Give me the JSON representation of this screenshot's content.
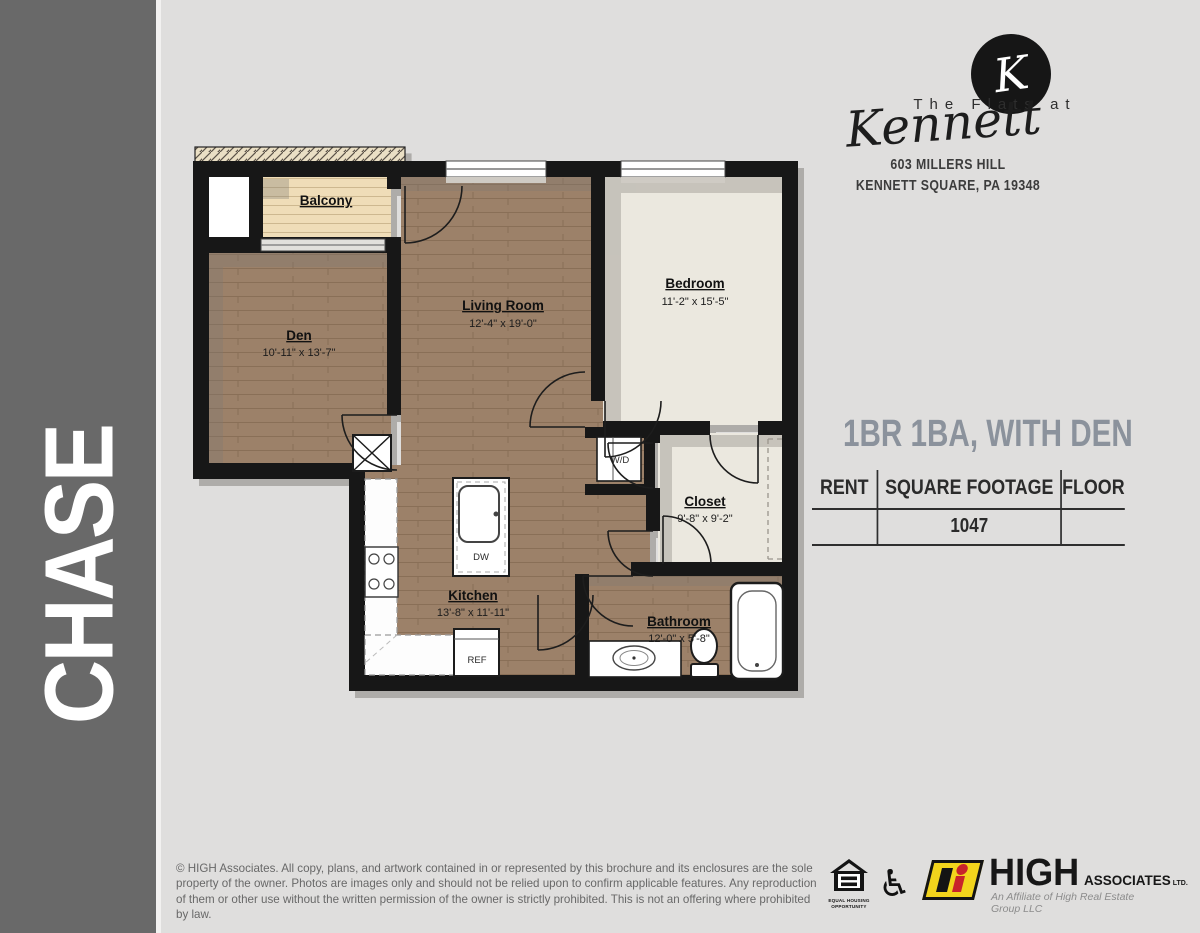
{
  "sidebar": {
    "plan_name": "CHASE"
  },
  "brand": {
    "monogram": "K",
    "name_top": "The Flats at",
    "name_script": "Kennett",
    "address_line1": "603 MILLERS HILL",
    "address_line2": "KENNETT SQUARE, PA 19348"
  },
  "unit": {
    "headline": "1BR 1BA, WITH DEN",
    "specs": {
      "columns": [
        "RENT",
        "SQUARE FOOTAGE",
        "FLOOR"
      ],
      "rent": "",
      "square_footage": "1047",
      "floor": ""
    }
  },
  "floorplan": {
    "rooms": {
      "balcony": {
        "name": "Balcony"
      },
      "den": {
        "name": "Den",
        "dims": "10'-11\" x 13'-7\""
      },
      "living": {
        "name": "Living Room",
        "dims": "12'-4\" x 19'-0\""
      },
      "bedroom": {
        "name": "Bedroom",
        "dims": "11'-2\" x 15'-5\""
      },
      "closet": {
        "name": "Closet",
        "dims": "9'-8\" x 9'-2\""
      },
      "kitchen": {
        "name": "Kitchen",
        "dims": "13'-8\" x 11'-11\""
      },
      "bathroom": {
        "name": "Bathroom",
        "dims": "12'-0\" x 5'-8\""
      }
    },
    "fixtures": {
      "washer_dryer": "W/D",
      "dishwasher": "DW",
      "refrigerator": "REF"
    }
  },
  "footer": {
    "legal": "© HIGH Associates. All copy, plans, and artwork contained in or represented by this brochure and its enclosures are the sole property of the owner. Photos are images only and should not be relied upon to confirm applicable features. Any reproduction of them or other use without the written permission of the owner is strictly prohibited. This is not an offering where prohibited by law.",
    "eho_label": "EQUAL HOUSING OPPORTUNITY",
    "high": {
      "name": "HIGH",
      "suffix": "ASSOCIATES",
      "ltd": "LTD.",
      "tagline": "An Affiliate of High Real Estate Group LLC"
    }
  },
  "colors": {
    "headline_accent": "#8b929c",
    "sidebar_gray": "#696969",
    "wood_floor": "#9c8169",
    "carpet": "#ebe8df",
    "balcony_deck": "#efddb8",
    "high_yellow": "#f2d41c",
    "high_red": "#c8232b"
  }
}
